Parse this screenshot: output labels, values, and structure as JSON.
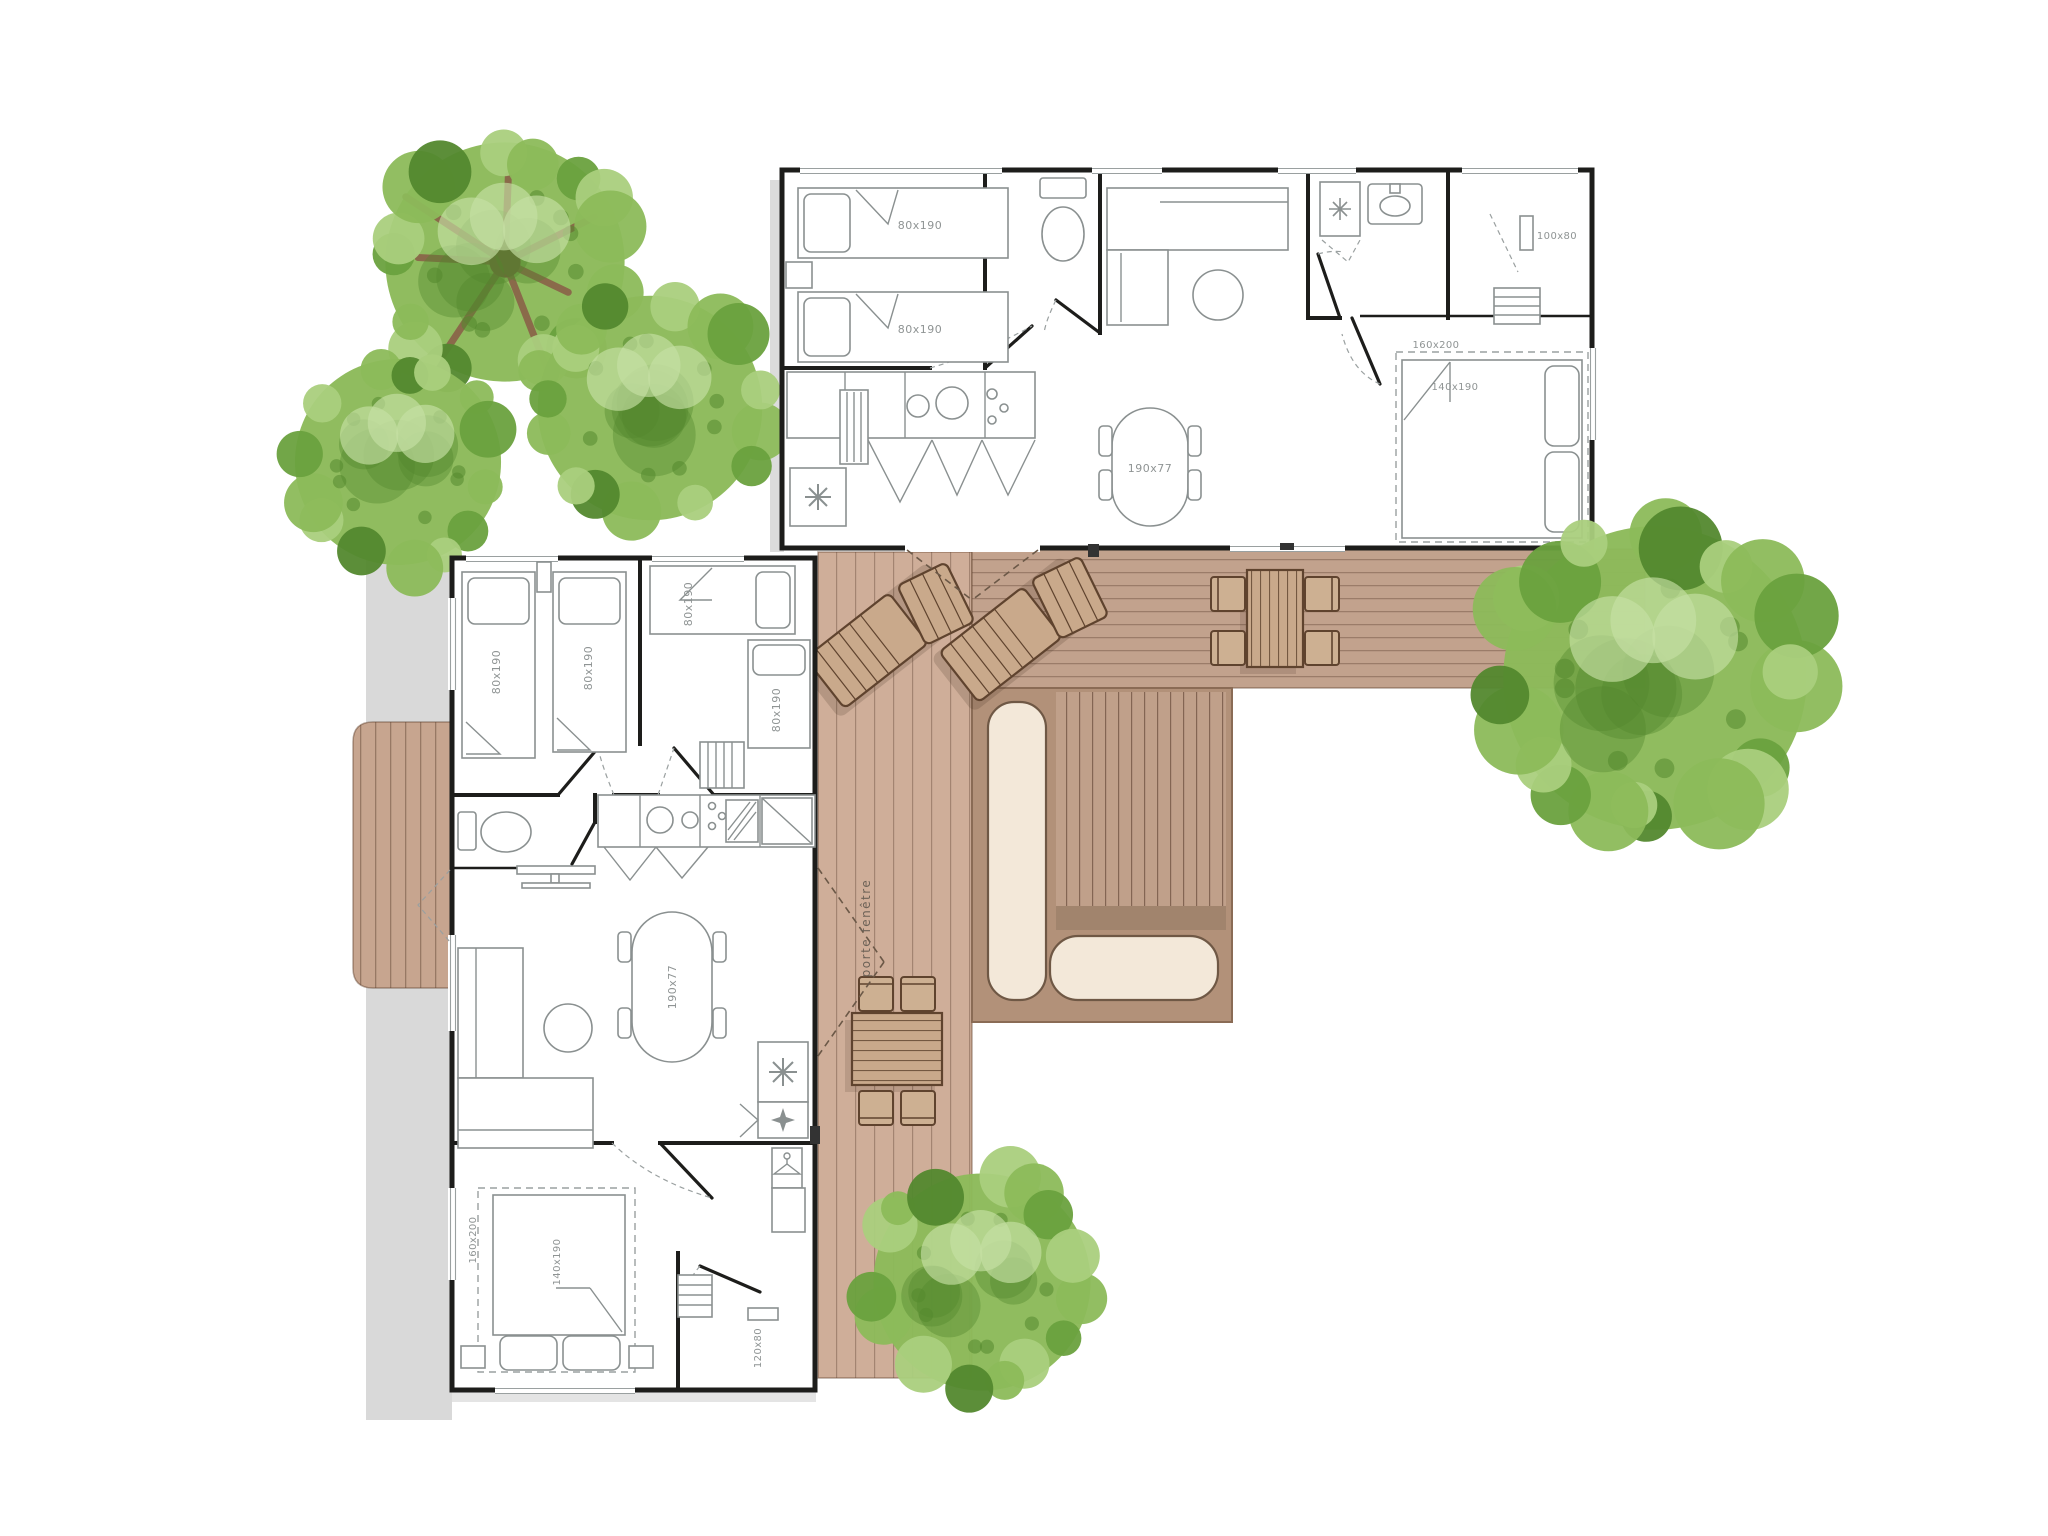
{
  "floor_plan": {
    "labels": {
      "single_bed": "80x190",
      "double_bed": "140x190",
      "bed_zone": "160x200",
      "dining_table": "190x77",
      "wardrobe": "100x80",
      "shower": "120x80",
      "french_door": "porte fenêtre"
    },
    "colors": {
      "wall": "#1d1d1b",
      "furniture_line": "#8a9090",
      "label_text": "#8f9494",
      "deck_light": "#cfae99",
      "deck_mid": "#c2a28d",
      "deck_dark": "#b29179",
      "deck_band": "#a1846d",
      "cushion": "#f3e8d9",
      "cushion_border": "#6f5845",
      "wood_furniture": "#c9a98b",
      "wood_border": "#5f432e",
      "shadow_grey": "#d9d9d9",
      "tree_base": "#8cba5a",
      "tree_light": "#aacf7d",
      "tree_lighter": "#c6e0a4",
      "tree_dark": "#6aa13e",
      "tree_deep": "#53882e",
      "branch": "#8a6a4a"
    }
  }
}
